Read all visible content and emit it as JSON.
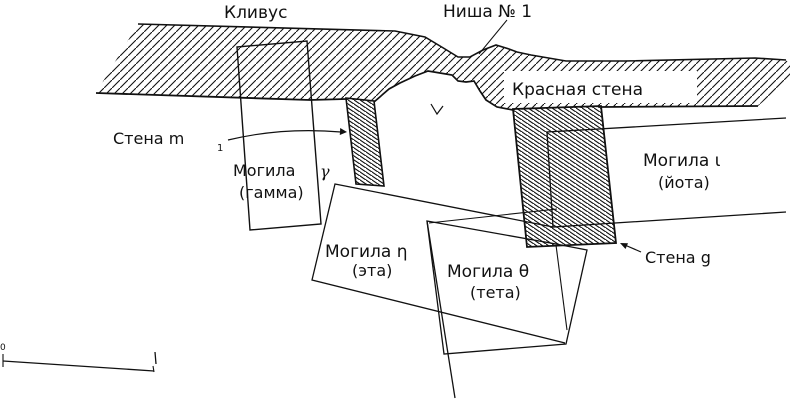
{
  "figure": {
    "type": "archaeological-plan-drawing",
    "labels": {
      "clivus": "Кливус",
      "niche": "Ниша № 1",
      "red_wall": "Красная стена",
      "wall_m1_text": "Стена m",
      "wall_m1_sub": "1",
      "grave_gamma_word": "Могила",
      "grave_gamma_letter": "γ",
      "grave_gamma_alt": "(гамма)",
      "grave_eta": "Могила η",
      "grave_eta_alt": "(эта)",
      "grave_theta": "Могила θ",
      "grave_theta_alt": "(тета)",
      "grave_iota": "Могила ι",
      "grave_iota_alt": "(йота)",
      "wall_g": "Стена g",
      "scale_zero": "0"
    },
    "icons": {
      "wall_m1_arrow": "arrow-right",
      "wall_g_arrow": "arrow-up-left"
    },
    "colors": {
      "ink": "#111111",
      "paper": "#ffffff"
    }
  }
}
